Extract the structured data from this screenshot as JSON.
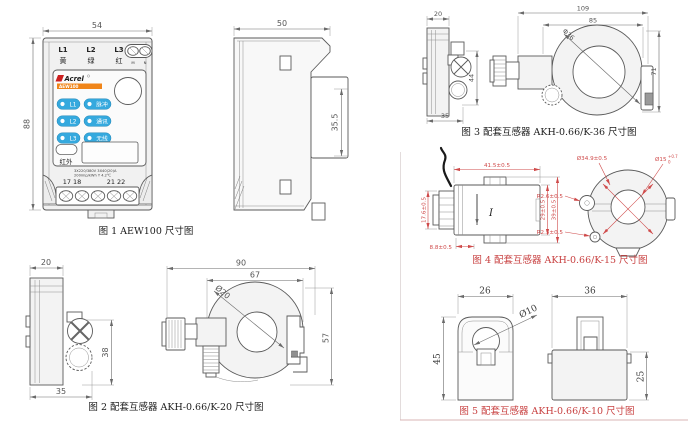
{
  "figures": {
    "fig1": {
      "caption": "图 1 AEW100 尺寸图",
      "dim_width": "54",
      "dim_height": "88",
      "device": {
        "phases": [
          "L1",
          "L2",
          "L3"
        ],
        "phase_colors": [
          "黄",
          "绿",
          "红"
        ],
        "aux_terminals": [
          "M",
          "N"
        ],
        "brand": "Acrel",
        "model": "AEW100",
        "led_rows": [
          {
            "left": "L1",
            "right": "脉冲"
          },
          {
            "left": "L2",
            "right": "通讯"
          },
          {
            "left": "L3",
            "right": "无线"
          }
        ],
        "infrared_label": "红外",
        "spec_line1": "3X220/380V 3X40(20)A",
        "spec_line2": "200imp/kWh Y 4.2℃",
        "terminals_left": "17 18",
        "terminals_right": "21 22"
      }
    },
    "side": {
      "dim_width": "50",
      "dim_rail": "35.5"
    },
    "fig2": {
      "caption": "图 2 配套互感器 AKH-0.66/K-20 尺寸图",
      "dim_top": "20",
      "dim_side_height": "38",
      "dim_side_depth": "35",
      "dim_overall": "90",
      "dim_body": "67",
      "dim_aperture": "Ø20",
      "dim_height": "57"
    },
    "fig3": {
      "caption": "图 3 配套互感器 AKH-0.66/K-36 尺寸图",
      "dim_top": "20",
      "dim_side_height": "44",
      "dim_side_depth": "35",
      "dim_overall": "109",
      "dim_body": "85",
      "dim_aperture": "Φ36",
      "dim_height": "71"
    },
    "fig4": {
      "caption": "图 4 配套互感器 AKH-0.66/K-15 尺寸图",
      "dim_width": "41.5±0.5",
      "dim_depth": "17.6±0.5",
      "dim_tab": "8.8±0.5",
      "dim_body_height": "29±0.5",
      "dim_overall_height": "39±0.5",
      "dim_outer": "Ø34.9±0.5",
      "dim_hole": "Ø15",
      "hole_tol_upper": "+0.7",
      "hole_tol_lower": "0",
      "dim_r_left": "R2.6±0.5",
      "dim_r_bottom": "R2.5±0.5",
      "current_mark": "I"
    },
    "fig5": {
      "caption": "图 5 配套互感器 AKH-0.66/K-10 尺寸图",
      "dim_front_width": "26",
      "dim_front_height": "45",
      "dim_aperture": "Ø10",
      "dim_side_width": "36",
      "dim_side_height": "25"
    }
  },
  "colors": {
    "dim_red": "#cf4a4a",
    "led_blue": "#35a9de",
    "brand_orange": "#f08519"
  }
}
